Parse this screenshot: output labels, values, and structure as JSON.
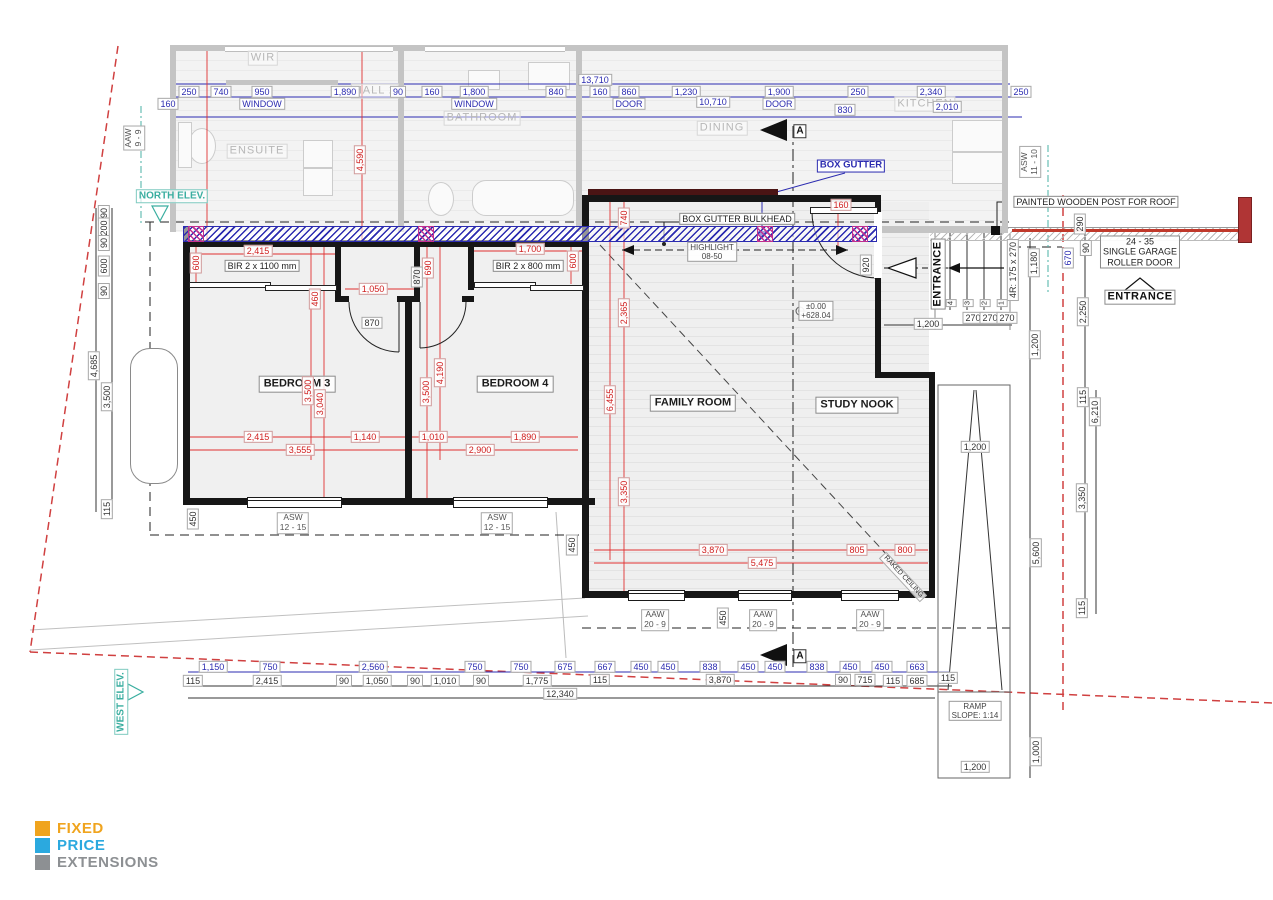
{
  "logo": {
    "items": [
      {
        "label": "FIXED",
        "color": "#F0A41E"
      },
      {
        "label": "PRICE",
        "color": "#2BA9DF"
      },
      {
        "label": "EXTENSIONS",
        "color": "#8D9093"
      }
    ]
  },
  "colors": {
    "dim_blue": "#2B2BB0",
    "dim_red": "#D02020",
    "teal_elev": "#3AAEA0",
    "boundary_red": "#D04040",
    "wall_black": "#161616",
    "existing_gray": "#C4C4C4"
  },
  "annotations": [
    {
      "t": "WIR",
      "x": 263,
      "y": 58,
      "c": "ro",
      "n": "room-label-wir"
    },
    {
      "t": "ENSUITE",
      "x": 257,
      "y": 151,
      "c": "ro",
      "n": "room-label-ensuite"
    },
    {
      "t": "HALL 2",
      "x": 375,
      "y": 91,
      "c": "ro",
      "n": "room-label-hall2"
    },
    {
      "t": "BATHROOM",
      "x": 482,
      "y": 118,
      "c": "ro",
      "n": "room-label-bathroom"
    },
    {
      "t": "DINING",
      "x": 722,
      "y": 128,
      "c": "ro",
      "n": "room-label-dining"
    },
    {
      "t": "KITCHEN",
      "x": 925,
      "y": 104,
      "c": "ro",
      "n": "room-label-kitchen"
    },
    {
      "t": "13,710",
      "x": 595,
      "y": 80,
      "c": "b"
    },
    {
      "t": "250",
      "x": 189,
      "y": 92,
      "c": "b"
    },
    {
      "t": "740",
      "x": 221,
      "y": 92,
      "c": "b"
    },
    {
      "t": "950",
      "x": 262,
      "y": 92,
      "c": "b"
    },
    {
      "t": "1,890",
      "x": 345,
      "y": 92,
      "c": "b"
    },
    {
      "t": "90",
      "x": 398,
      "y": 92,
      "c": "b"
    },
    {
      "t": "160",
      "x": 432,
      "y": 92,
      "c": "b"
    },
    {
      "t": "1,800",
      "x": 474,
      "y": 92,
      "c": "b"
    },
    {
      "t": "840",
      "x": 556,
      "y": 92,
      "c": "b"
    },
    {
      "t": "160",
      "x": 600,
      "y": 92,
      "c": "b"
    },
    {
      "t": "860",
      "x": 629,
      "y": 92,
      "c": "b"
    },
    {
      "t": "1,230",
      "x": 686,
      "y": 92,
      "c": "b"
    },
    {
      "t": "1,900",
      "x": 779,
      "y": 92,
      "c": "b"
    },
    {
      "t": "250",
      "x": 858,
      "y": 92,
      "c": "b"
    },
    {
      "t": "2,340",
      "x": 931,
      "y": 92,
      "c": "b"
    },
    {
      "t": "250",
      "x": 1021,
      "y": 92,
      "c": "b"
    },
    {
      "t": "160",
      "x": 168,
      "y": 104,
      "c": "b"
    },
    {
      "t": "WINDOW",
      "x": 262,
      "y": 104,
      "c": "b"
    },
    {
      "t": "WINDOW",
      "x": 474,
      "y": 104,
      "c": "b"
    },
    {
      "t": "10,710",
      "x": 713,
      "y": 102,
      "c": "b"
    },
    {
      "t": "DOOR",
      "x": 629,
      "y": 104,
      "c": "b"
    },
    {
      "t": "DOOR",
      "x": 779,
      "y": 104,
      "c": "b"
    },
    {
      "t": "830",
      "x": 845,
      "y": 110,
      "c": "b"
    },
    {
      "t": "2,010",
      "x": 947,
      "y": 107,
      "c": "b"
    },
    {
      "t": "BEDROOM 3",
      "x": 297,
      "y": 384,
      "c": "rn",
      "n": "room-label-bedroom-3"
    },
    {
      "t": "BEDROOM 4",
      "x": 515,
      "y": 384,
      "c": "rn",
      "n": "room-label-bedroom-4"
    },
    {
      "t": "FAMILY ROOM",
      "x": 693,
      "y": 403,
      "c": "rn",
      "n": "room-label-family-room"
    },
    {
      "t": "STUDY NOOK",
      "x": 857,
      "y": 405,
      "c": "rn",
      "n": "room-label-study-nook"
    },
    {
      "t": "BIR 2 x 1100 mm",
      "x": 262,
      "y": 266,
      "c": "nd",
      "n": "robe-label-bir-1100"
    },
    {
      "t": "BIR 2 x 800 mm",
      "x": 528,
      "y": 266,
      "c": "nd",
      "n": "robe-label-bir-800"
    },
    {
      "t": "2,415",
      "x": 258,
      "y": 251,
      "c": "r"
    },
    {
      "t": "600",
      "x": 196,
      "y": 263,
      "c": "r",
      "r": 1
    },
    {
      "t": "1,050",
      "x": 373,
      "y": 289,
      "c": "r"
    },
    {
      "t": "460",
      "x": 315,
      "y": 299,
      "c": "r",
      "r": 1
    },
    {
      "t": "3,500",
      "x": 308,
      "y": 391,
      "c": "r",
      "r": 1
    },
    {
      "t": "3,040",
      "x": 320,
      "y": 404,
      "c": "r",
      "r": 1
    },
    {
      "t": "690",
      "x": 428,
      "y": 268,
      "c": "r",
      "r": 1
    },
    {
      "t": "1,700",
      "x": 530,
      "y": 249,
      "c": "r"
    },
    {
      "t": "600",
      "x": 573,
      "y": 261,
      "c": "r",
      "r": 1
    },
    {
      "t": "4,190",
      "x": 440,
      "y": 373,
      "c": "r",
      "r": 1
    },
    {
      "t": "3,500",
      "x": 426,
      "y": 392,
      "c": "r",
      "r": 1
    },
    {
      "t": "2,365",
      "x": 624,
      "y": 313,
      "c": "r",
      "r": 1
    },
    {
      "t": "6,455",
      "x": 610,
      "y": 400,
      "c": "r",
      "r": 1
    },
    {
      "t": "3,350",
      "x": 624,
      "y": 492,
      "c": "r",
      "r": 1
    },
    {
      "t": "740",
      "x": 624,
      "y": 218,
      "c": "r",
      "r": 1
    },
    {
      "t": "160",
      "x": 841,
      "y": 205,
      "c": "r"
    },
    {
      "t": "4,590",
      "x": 360,
      "y": 160,
      "c": "r",
      "r": 1
    },
    {
      "t": "2,415",
      "x": 258,
      "y": 437,
      "c": "r"
    },
    {
      "t": "1,140",
      "x": 365,
      "y": 437,
      "c": "r"
    },
    {
      "t": "1,010",
      "x": 433,
      "y": 437,
      "c": "r"
    },
    {
      "t": "1,890",
      "x": 525,
      "y": 437,
      "c": "r"
    },
    {
      "t": "3,555",
      "x": 300,
      "y": 450,
      "c": "r"
    },
    {
      "t": "2,900",
      "x": 480,
      "y": 450,
      "c": "r"
    },
    {
      "t": "3,870",
      "x": 713,
      "y": 550,
      "c": "r"
    },
    {
      "t": "805",
      "x": 857,
      "y": 550,
      "c": "r"
    },
    {
      "t": "800",
      "x": 905,
      "y": 550,
      "c": "r"
    },
    {
      "t": "5,475",
      "x": 762,
      "y": 563,
      "c": "r"
    },
    {
      "t": "870",
      "x": 372,
      "y": 323,
      "c": "d"
    },
    {
      "t": "870",
      "x": 417,
      "y": 277,
      "c": "d",
      "r": 1
    },
    {
      "t": "920",
      "x": 866,
      "y": 265,
      "c": "d",
      "r": 1
    },
    {
      "t": "450",
      "x": 572,
      "y": 545,
      "c": "d",
      "r": 1
    },
    {
      "t": "450",
      "x": 723,
      "y": 618,
      "c": "d",
      "r": 1
    },
    {
      "t": "90",
      "x": 104,
      "y": 213,
      "c": "d",
      "r": 1
    },
    {
      "t": "200",
      "x": 104,
      "y": 228,
      "c": "d",
      "r": 1
    },
    {
      "t": "90",
      "x": 104,
      "y": 243,
      "c": "d",
      "r": 1
    },
    {
      "t": "600",
      "x": 104,
      "y": 266,
      "c": "d",
      "r": 1
    },
    {
      "t": "90",
      "x": 104,
      "y": 291,
      "c": "d",
      "r": 1
    },
    {
      "t": "4,685",
      "x": 94,
      "y": 366,
      "c": "d",
      "r": 1
    },
    {
      "t": "3,500",
      "x": 107,
      "y": 397,
      "c": "d",
      "r": 1
    },
    {
      "t": "115",
      "x": 107,
      "y": 509,
      "c": "d",
      "r": 1
    },
    {
      "t": "450",
      "x": 193,
      "y": 519,
      "c": "d",
      "r": 1
    },
    {
      "t": "270",
      "x": 973,
      "y": 318,
      "c": "d"
    },
    {
      "t": "270",
      "x": 990,
      "y": 318,
      "c": "d"
    },
    {
      "t": "270",
      "x": 1007,
      "y": 318,
      "c": "d"
    },
    {
      "t": "1,200",
      "x": 928,
      "y": 324,
      "c": "d"
    },
    {
      "t": "4R: 175 x 270",
      "x": 1013,
      "y": 270,
      "c": "d",
      "r": 1
    },
    {
      "t": "1,180",
      "x": 1034,
      "y": 263,
      "c": "d",
      "r": 1
    },
    {
      "t": "290",
      "x": 1080,
      "y": 224,
      "c": "d",
      "r": 1
    },
    {
      "t": "90",
      "x": 1086,
      "y": 248,
      "c": "d",
      "r": 1
    },
    {
      "t": "670",
      "x": 1068,
      "y": 258,
      "c": "b",
      "r": 1
    },
    {
      "t": "2,250",
      "x": 1083,
      "y": 312,
      "c": "d",
      "r": 1
    },
    {
      "t": "1,200",
      "x": 1035,
      "y": 345,
      "c": "d",
      "r": 1
    },
    {
      "t": "115",
      "x": 1083,
      "y": 397,
      "c": "d",
      "r": 1
    },
    {
      "t": "6,210",
      "x": 1095,
      "y": 412,
      "c": "d",
      "r": 1
    },
    {
      "t": "3,350",
      "x": 1082,
      "y": 498,
      "c": "d",
      "r": 1
    },
    {
      "t": "5,600",
      "x": 1036,
      "y": 553,
      "c": "d",
      "r": 1
    },
    {
      "t": "115",
      "x": 1082,
      "y": 608,
      "c": "d",
      "r": 1
    },
    {
      "t": "1,000",
      "x": 1036,
      "y": 752,
      "c": "d",
      "r": 1
    },
    {
      "t": "1,200",
      "x": 975,
      "y": 447,
      "c": "d"
    },
    {
      "t": "1,200",
      "x": 975,
      "y": 767,
      "c": "d"
    },
    {
      "t": "4",
      "x": 951,
      "y": 303,
      "c": "num",
      "r": 1
    },
    {
      "t": "3",
      "x": 968,
      "y": 303,
      "c": "num",
      "r": 1
    },
    {
      "t": "2",
      "x": 985,
      "y": 303,
      "c": "num",
      "r": 1
    },
    {
      "t": "1",
      "x": 1002,
      "y": 303,
      "c": "num",
      "r": 1
    },
    {
      "t": "1,150",
      "x": 213,
      "y": 667,
      "c": "b"
    },
    {
      "t": "750",
      "x": 270,
      "y": 667,
      "c": "b"
    },
    {
      "t": "2,560",
      "x": 373,
      "y": 667,
      "c": "b"
    },
    {
      "t": "750",
      "x": 475,
      "y": 667,
      "c": "b"
    },
    {
      "t": "750",
      "x": 521,
      "y": 667,
      "c": "b"
    },
    {
      "t": "675",
      "x": 565,
      "y": 667,
      "c": "b"
    },
    {
      "t": "667",
      "x": 605,
      "y": 667,
      "c": "b"
    },
    {
      "t": "450",
      "x": 641,
      "y": 667,
      "c": "b"
    },
    {
      "t": "450",
      "x": 668,
      "y": 667,
      "c": "b"
    },
    {
      "t": "838",
      "x": 710,
      "y": 667,
      "c": "b"
    },
    {
      "t": "450",
      "x": 748,
      "y": 667,
      "c": "b"
    },
    {
      "t": "450",
      "x": 775,
      "y": 667,
      "c": "b"
    },
    {
      "t": "838",
      "x": 817,
      "y": 667,
      "c": "b"
    },
    {
      "t": "450",
      "x": 850,
      "y": 667,
      "c": "b"
    },
    {
      "t": "450",
      "x": 882,
      "y": 667,
      "c": "b"
    },
    {
      "t": "663",
      "x": 917,
      "y": 667,
      "c": "b"
    },
    {
      "t": "115",
      "x": 193,
      "y": 681,
      "c": "d"
    },
    {
      "t": "2,415",
      "x": 267,
      "y": 681,
      "c": "d"
    },
    {
      "t": "90",
      "x": 344,
      "y": 681,
      "c": "d"
    },
    {
      "t": "1,050",
      "x": 377,
      "y": 681,
      "c": "d"
    },
    {
      "t": "90",
      "x": 415,
      "y": 681,
      "c": "d"
    },
    {
      "t": "1,010",
      "x": 445,
      "y": 681,
      "c": "d"
    },
    {
      "t": "90",
      "x": 481,
      "y": 681,
      "c": "d"
    },
    {
      "t": "1,775",
      "x": 537,
      "y": 681,
      "c": "d"
    },
    {
      "t": "115",
      "x": 600,
      "y": 680,
      "c": "d"
    },
    {
      "t": "3,870",
      "x": 720,
      "y": 680,
      "c": "d"
    },
    {
      "t": "90",
      "x": 843,
      "y": 680,
      "c": "d"
    },
    {
      "t": "715",
      "x": 865,
      "y": 680,
      "c": "d"
    },
    {
      "t": "115",
      "x": 893,
      "y": 681,
      "c": "d"
    },
    {
      "t": "685",
      "x": 917,
      "y": 681,
      "c": "d"
    },
    {
      "t": "115",
      "x": 948,
      "y": 678,
      "c": "d"
    },
    {
      "t": "12,340",
      "x": 560,
      "y": 694,
      "c": "d"
    },
    {
      "t": "ASW\n12 - 15",
      "x": 293,
      "y": 523,
      "c": "w",
      "n": "window-label-asw-12-15"
    },
    {
      "t": "ASW\n12 - 15",
      "x": 497,
      "y": 523,
      "c": "w",
      "n": "window-label-asw-12-15"
    },
    {
      "t": "AAW\n20 - 9",
      "x": 655,
      "y": 620,
      "c": "w",
      "n": "window-label-aaw-20-9"
    },
    {
      "t": "AAW\n20 - 9",
      "x": 763,
      "y": 620,
      "c": "w",
      "n": "window-label-aaw-20-9"
    },
    {
      "t": "AAW\n20 - 9",
      "x": 870,
      "y": 620,
      "c": "w",
      "n": "window-label-aaw-20-9"
    },
    {
      "t": "AAW\n9 - 9",
      "x": 134,
      "y": 138,
      "c": "w",
      "r": 1,
      "n": "window-label-aaw-9-9"
    },
    {
      "t": "ASW\n11 - 10",
      "x": 1030,
      "y": 162,
      "c": "w",
      "r": 1,
      "n": "window-label-asw-11-10"
    },
    {
      "t": "BOX GUTTER",
      "x": 851,
      "y": 166,
      "c": "cb",
      "n": "callout-box-gutter"
    },
    {
      "t": "BOX GUTTER BULKHEAD",
      "x": 737,
      "y": 219,
      "c": "nd",
      "n": "callout-box-gutter-bulkhead"
    },
    {
      "t": "HIGHLIGHT\n08-50",
      "x": 712,
      "y": 252,
      "c": "td",
      "n": "callout-highlight-window"
    },
    {
      "t": "PAINTED WOODEN POST FOR ROOF",
      "x": 1096,
      "y": 202,
      "c": "nd",
      "n": "callout-painted-post"
    },
    {
      "t": "24 - 35\nSINGLE GARAGE\nROLLER DOOR",
      "x": 1140,
      "y": 252,
      "c": "nd",
      "n": "callout-garage-roller-door"
    },
    {
      "t": "ENTRANCE",
      "x": 1140,
      "y": 297,
      "c": "en",
      "n": "entrance-label-east"
    },
    {
      "t": "ENTRANCE",
      "x": 938,
      "y": 274,
      "c": "en",
      "r": 1,
      "n": "entrance-label-stairs"
    },
    {
      "t": "RAMP\nSLOPE: 1:14",
      "x": 975,
      "y": 711,
      "c": "td",
      "n": "callout-ramp-slope"
    },
    {
      "t": "±0.00\n+628.04",
      "x": 816,
      "y": 311,
      "c": "td",
      "n": "level-marker"
    },
    {
      "t": "RAKED CEILING",
      "x": 903,
      "y": 577,
      "c": "rk",
      "n": "callout-raked-ceiling"
    },
    {
      "t": "NORTH ELEV.",
      "x": 172,
      "y": 196,
      "c": "el",
      "n": "elevation-marker-north"
    },
    {
      "t": "WEST ELEV.",
      "x": 121,
      "y": 702,
      "c": "el",
      "r": 1,
      "n": "elevation-marker-west"
    },
    {
      "t": "A",
      "x": 800,
      "y": 131,
      "c": "sa",
      "n": "section-marker-a-top"
    },
    {
      "t": "A",
      "x": 800,
      "y": 656,
      "c": "sa",
      "n": "section-marker-a-bottom"
    }
  ]
}
